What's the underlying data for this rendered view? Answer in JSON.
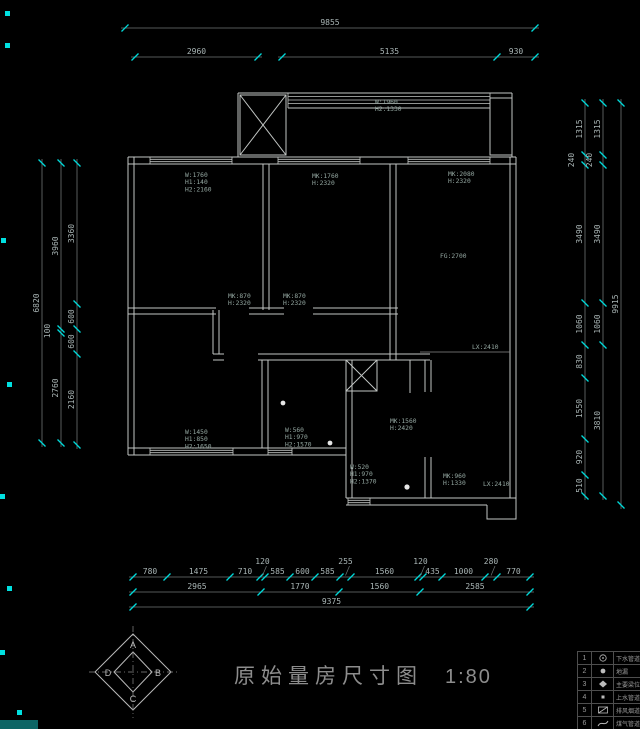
{
  "drawing": {
    "title": "原始量房尺寸图",
    "scale": "1:80"
  },
  "dimensions": {
    "top": {
      "overall": [
        "9855"
      ],
      "row2a": [
        "2960"
      ],
      "row2b": [
        "5135",
        "930"
      ]
    },
    "left": {
      "overall": [
        "6820"
      ],
      "mid": [
        "3960",
        "100",
        "2760"
      ],
      "inner": [
        "3360",
        "600",
        "600",
        "2160"
      ]
    },
    "right": {
      "inner": [
        "1315",
        "240",
        "3490",
        "1060",
        "830",
        "1550",
        "920",
        "510"
      ],
      "mid": [
        "1315",
        "240",
        "3490",
        "1060",
        "3810"
      ],
      "overall": [
        "9915"
      ]
    },
    "bottom": {
      "row1": [
        "780",
        "1475",
        "710",
        "120",
        "585",
        "600",
        "585",
        "255",
        "1560",
        "120",
        "435",
        "1000",
        "280",
        "770"
      ],
      "row2": [
        "2965",
        "1770",
        "1560",
        "2585"
      ],
      "overall": [
        "9375"
      ]
    }
  },
  "labels": {
    "balcony_window": [
      "W:1960",
      "H2:1330"
    ],
    "bed1_window": [
      "W:1760",
      "H1:140",
      "H2:2160"
    ],
    "bed2_window": [
      "MK:1760",
      "H:2320"
    ],
    "living_window": [
      "MK:2080",
      "H:2320"
    ],
    "ceiling_height": [
      "FG:2700"
    ],
    "bed1_door": [
      "MK:870",
      "H:2320"
    ],
    "bed2_door": [
      "MK:870",
      "H:2320"
    ],
    "west_window": [
      "W:1450",
      "H1:850",
      "H2:1650"
    ],
    "small_window": [
      "W:560",
      "H1:970",
      "H2:1570"
    ],
    "bath_window": [
      "W:520",
      "H1:970",
      "H2:1370"
    ],
    "kitchen_door": [
      "MK:1560",
      "H:2420"
    ],
    "small_door": [
      "MK:960",
      "H:1330"
    ],
    "beam_living": [
      "LX:2410"
    ],
    "beam_bottom": [
      "LX:2410"
    ]
  },
  "compass": {
    "top": "A",
    "right": "B",
    "bottom": "C",
    "left": "D"
  },
  "legend": {
    "rows": [
      {
        "num": "1",
        "symbol": "drain-pipe-icon",
        "label": "下水管道"
      },
      {
        "num": "2",
        "symbol": "floor-drain-icon",
        "label": "地漏"
      },
      {
        "num": "3",
        "symbol": "beam-icon",
        "label": "主要梁位置"
      },
      {
        "num": "4",
        "symbol": "water-pipe-icon",
        "label": "上水管道"
      },
      {
        "num": "5",
        "symbol": "vent-duct-icon",
        "label": "排风烟道"
      },
      {
        "num": "6",
        "symbol": "gas-pipe-icon",
        "label": "煤气管道"
      }
    ]
  },
  "colors": {
    "background": "#000000",
    "wall": "#c2c6c4",
    "dim_line": "#6f7575",
    "dim_text": "#a9b5b5",
    "tick_accent": "#00d9d9",
    "label_text": "#95a8a2"
  }
}
